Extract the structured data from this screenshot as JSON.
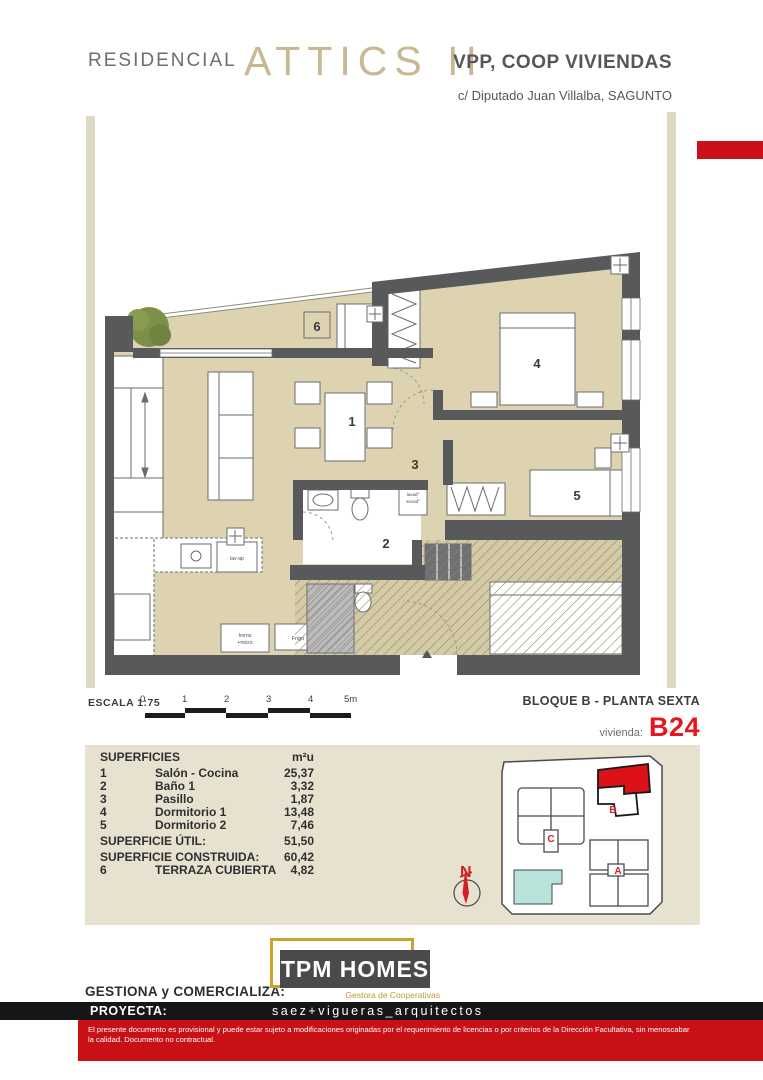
{
  "header": {
    "brand": "RESIDENCIAL",
    "project": "ATTICS II",
    "housing_type": "VPP, COOP VIVIENDAS",
    "address": "c/ Diputado Juan Villalba, SAGUNTO"
  },
  "scale": {
    "label": "ESCALA 1:75",
    "ticks": [
      "0",
      "1",
      "2",
      "3",
      "4",
      "5m"
    ]
  },
  "location": {
    "block": "BLOQUE B - PLANTA SEXTA",
    "unit_label": "vivienda:",
    "unit_code": "B24"
  },
  "plan": {
    "rooms": [
      "1",
      "2",
      "3",
      "4",
      "5",
      "6"
    ],
    "annotations": {
      "washer": "lavad°",
      "dryer": "secad°",
      "dishwasher": "lav-ap",
      "oven_line1": "horno",
      "oven_line2": "+micro",
      "fridge": "Frigo"
    }
  },
  "surfaces": {
    "title": "SUPERFICIES",
    "unit_header": "m²u",
    "rows": [
      {
        "num": "1",
        "name": "Salón - Cocina",
        "value": "25,37"
      },
      {
        "num": "2",
        "name": "Baño 1",
        "value": "3,32"
      },
      {
        "num": "3",
        "name": "Pasillo",
        "value": "1,87"
      },
      {
        "num": "4",
        "name": "Dormitorio 1",
        "value": "13,48"
      },
      {
        "num": "5",
        "name": "Dormitorio 2",
        "value": "7,46"
      }
    ],
    "total_util": {
      "name": "SUPERFICIE ÚTIL:",
      "value": "51,50"
    },
    "total_built": {
      "name": "SUPERFICIE CONSTRUIDA:",
      "value": "60,42"
    },
    "terrace": {
      "num": "6",
      "name": "TERRAZA CUBIERTA",
      "value": "4,82"
    }
  },
  "keyplan": {
    "block_c": "C",
    "block_b": "B",
    "block_a": "A",
    "north": "N"
  },
  "footer": {
    "manager_label": "GESTIONA y COMERCIALIZA:",
    "logo_title": "TPM HOMES",
    "logo_subtitle": "Gestora de Cooperativas",
    "architect_label": "PROYECTA:",
    "architect_name": "saez+vigueras_arquitectos",
    "disclaimer_line1": "El presente documento es provisional y puede estar sujeto a modificaciones originadas por el requerimiento de licencias o por criterios de la Dirección Facultativa, sin menoscabar",
    "disclaimer_line2": "la calidad. Documento no contractual."
  },
  "colors": {
    "accent_red": "#cb1117",
    "brand_tan": "#c9b894",
    "bar_tan": "#ded9c2",
    "panel_beige": "#e7e2cf",
    "floor_beige": "#ddd3b1",
    "wall_gray": "#58595b",
    "teal": "#b7e3da",
    "logo_gold": "#c9a42d"
  }
}
